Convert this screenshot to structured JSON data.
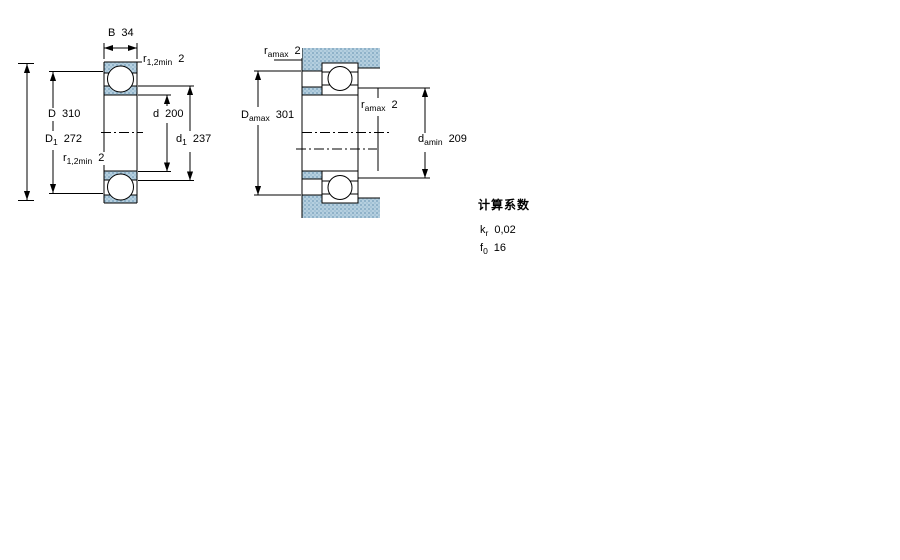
{
  "colors": {
    "hatch_base": "#b5cfdf",
    "hatch_dot": "#8fb2c9",
    "line": "#000000",
    "background": "#ffffff"
  },
  "left_diagram": {
    "description": "bearing cross-section with boundary dimensions",
    "b": {
      "sym": "B",
      "sub": "",
      "value": "34"
    },
    "r12_top": {
      "sym": "r",
      "sub": "1,2min",
      "value": "2"
    },
    "D": {
      "sym": "D",
      "sub": "",
      "value": "310"
    },
    "D1": {
      "sym": "D",
      "sub": "1",
      "value": "272"
    },
    "r12_bottom": {
      "sym": "r",
      "sub": "1,2min",
      "value": "2"
    },
    "d": {
      "sym": "d",
      "sub": "",
      "value": "200"
    },
    "d1": {
      "sym": "d",
      "sub": "1",
      "value": "237"
    }
  },
  "right_diagram": {
    "description": "bearing mounting / abutment dimensions",
    "ra_top": {
      "sym": "r",
      "sub": "amax",
      "value": "2"
    },
    "Da": {
      "sym": "D",
      "sub": "amax",
      "value": "301"
    },
    "ra_mid": {
      "sym": "r",
      "sub": "amax",
      "value": "2"
    },
    "da": {
      "sym": "d",
      "sub": "amin",
      "value": "209"
    }
  },
  "factors": {
    "heading": "计算系数",
    "kr": {
      "sym": "k",
      "sub": "r",
      "value": "0,02"
    },
    "f0": {
      "sym": "f",
      "sub": "0",
      "value": "16"
    }
  }
}
